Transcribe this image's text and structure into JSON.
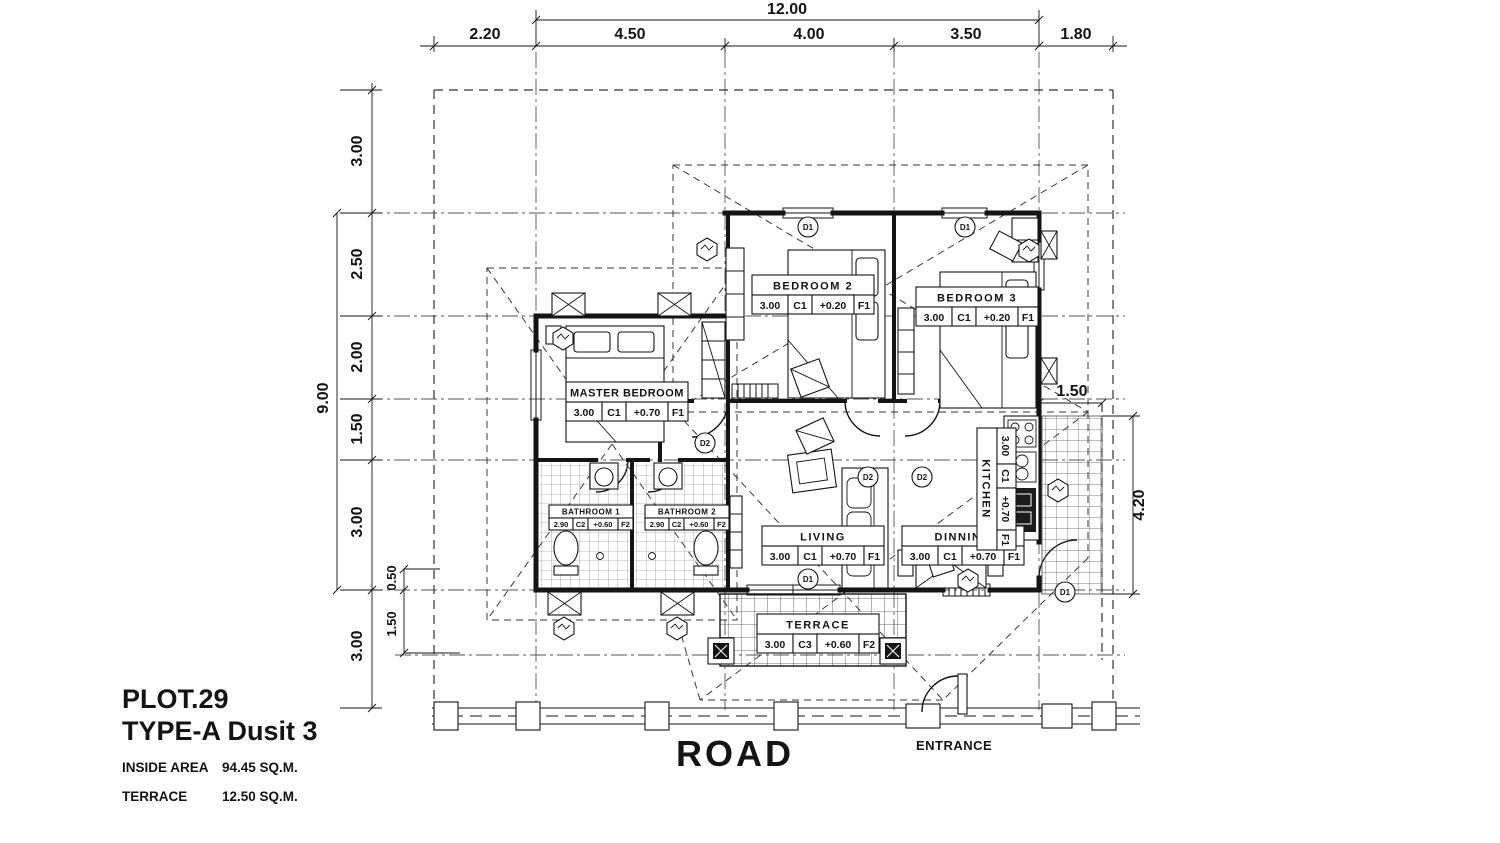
{
  "drawing": {
    "title_block": {
      "plot_no": "PLOT.29",
      "type_name": "TYPE-A Dusit 3",
      "inside_area_label": "INSIDE AREA",
      "inside_area_value": "94.45 SQ.M.",
      "terrace_area_label": "TERRACE",
      "terrace_area_value": "12.50 SQ.M."
    },
    "labels": {
      "road": "ROAD",
      "entrance": "ENTRANCE"
    },
    "dimensions": {
      "top_overall": "12.00",
      "top_segments": [
        "2.20",
        "4.50",
        "4.00",
        "3.50",
        "1.80"
      ],
      "left_overall": "9.00",
      "left_segments": [
        "3.00",
        "2.50",
        "2.00",
        "1.50",
        "3.00",
        "3.00"
      ],
      "left_minor": [
        "0.50",
        "1.50"
      ],
      "right_segments": [
        "1.50",
        "4.20"
      ]
    },
    "rooms": [
      {
        "name": "BEDROOM 2",
        "specs": [
          "3.00",
          "C1",
          "+0.20",
          "F1"
        ]
      },
      {
        "name": "BEDROOM 3",
        "specs": [
          "3.00",
          "C1",
          "+0.20",
          "F1"
        ]
      },
      {
        "name": "MASTER BEDROOM",
        "specs": [
          "3.00",
          "C1",
          "+0.70",
          "F1"
        ]
      },
      {
        "name": "BATHROOM 1",
        "specs": [
          "2.90",
          "C2",
          "+0.60",
          "F2"
        ]
      },
      {
        "name": "BATHROOM 2",
        "specs": [
          "2.90",
          "C2",
          "+0.60",
          "F2"
        ]
      },
      {
        "name": "LIVING",
        "specs": [
          "3.00",
          "C1",
          "+0.70",
          "F1"
        ]
      },
      {
        "name": "DINNING",
        "specs": [
          "3.00",
          "C1",
          "+0.70",
          "F1"
        ]
      },
      {
        "name": "KITCHEN",
        "specs": [
          "3.00",
          "C1",
          "+0.70",
          "F1"
        ]
      },
      {
        "name": "TERRACE",
        "specs": [
          "3.00",
          "C3",
          "+0.60",
          "F2"
        ]
      }
    ],
    "door_tags": {
      "d1": "D1",
      "d2": "D2"
    }
  }
}
